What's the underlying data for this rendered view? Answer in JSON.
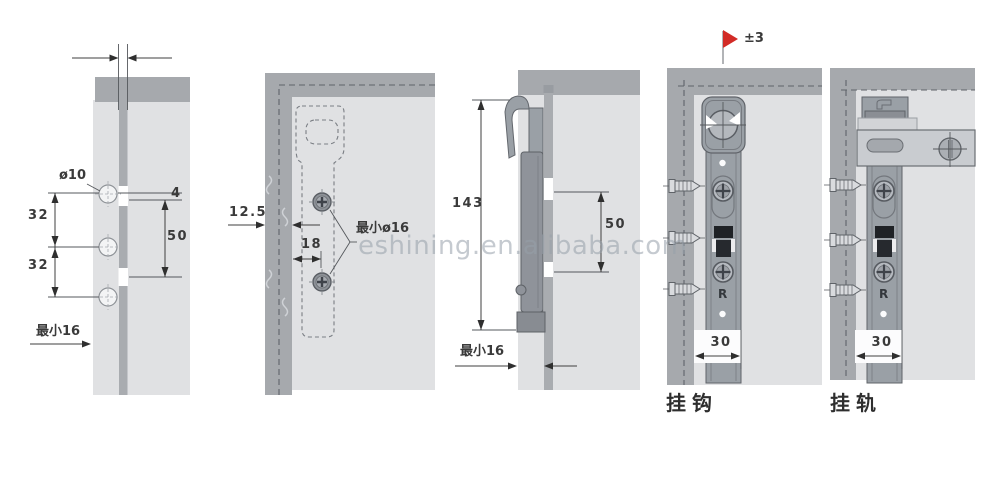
{
  "watermark": {
    "text": "eshining.en.alibaba.com",
    "color": "#97a0aa"
  },
  "colors": {
    "panel_face": "#e0e1e3",
    "panel_edge": "#a6a9ad",
    "groove": "#a9acb0",
    "hardware": "#9aa0a6",
    "rail": "#c9ccd0",
    "flag_red": "#d22b26",
    "dimension_text": "#3a3a3a"
  },
  "panels": {
    "slot_view": {
      "hole_dia": "ø10",
      "spacing_top": "32",
      "spacing_bottom": "32",
      "offset": "4",
      "slot_len": "50",
      "min_edge": "最小16"
    },
    "back_view": {
      "thickness": "12.5",
      "inset": "18",
      "min_hole": "最小ø16"
    },
    "section_view": {
      "height": "143",
      "slot_len": "50",
      "min_edge": "最小16"
    },
    "hook_view": {
      "tolerance": "±3",
      "width": "30",
      "marking": "R",
      "caption": "挂钩"
    },
    "rail_view": {
      "width": "30",
      "marking": "R",
      "caption": "挂轨"
    }
  }
}
